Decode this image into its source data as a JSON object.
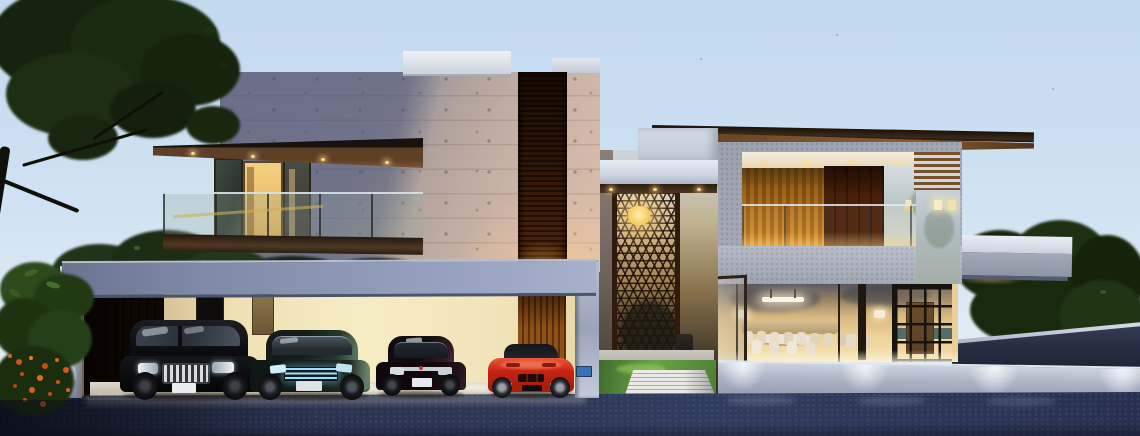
{
  "scene": {
    "type": "architectural-exterior-render",
    "time_of_day": "dusk",
    "description": "Modern two-storey villa at dusk: travertine and grey stucco volumes, warm-lit interiors, timber louvres, double-height entry lattice screen with pendant lamp, open carport with four parked cars, glass dining room, landscaped drive with uplit plinth wall, trees left and right"
  },
  "palette": {
    "sky_top": "#c3d9ef",
    "sky_mid": "#cfe2f3",
    "sky_low": "#e2ecf4",
    "travertine_shadow": "#84879f",
    "travertine_lit": "#dcbfab",
    "louver_wood": "#6e4a26",
    "wood_dark": "#3c2a18",
    "soffit_wood": "#7a5530",
    "carport_glow": "#f2e4ba",
    "fascia": "#8e99b6",
    "lattice_frame": "#2e1b0b",
    "pendant_glow": "#ffd98a",
    "stucco_gray": "#9ba1af",
    "curtain_warm": "#e8c06a",
    "interior_warm": "#efd49c",
    "plinth": "#aab1c2",
    "pool_light": "#f2f5fa",
    "asphalt": "#2a3350",
    "grass_lit": "#6ba344",
    "tree_dark": "#1b2b12",
    "hedge_dark": "#18260f",
    "flower_orange": "#e0601c",
    "car_suv": "#0b0c0e",
    "car_teal_sedan": "#15211c",
    "car_maroon_sedan": "#160d12",
    "car_red_sports": "#c62414"
  },
  "objects": {
    "cars": [
      {
        "name": "black-suv",
        "color": "#0b0c0e"
      },
      {
        "name": "dark-teal-sedan",
        "color": "#15211c"
      },
      {
        "name": "maroon-sedan",
        "color": "#160d12"
      },
      {
        "name": "red-sports-car",
        "color": "#c62414"
      }
    ],
    "vegetation": [
      "left-canopy-tree",
      "frangipani-bush",
      "mid-shrubs",
      "right-hedge"
    ],
    "lighting": [
      "balcony-downlights",
      "entry-pendant-lamp",
      "dining-linear-pendant",
      "soffit-recessed-lights",
      "plinth-wall-washers",
      "interior-sconces"
    ],
    "architecture": [
      "travertine-upper-volume",
      "timber-louver-strip",
      "cantilevered-balcony",
      "carport",
      "entry-lattice-screen",
      "grey-stucco-frame-volume",
      "timber-roof-plane",
      "glass-dining-room",
      "stepping-plank-path"
    ]
  }
}
